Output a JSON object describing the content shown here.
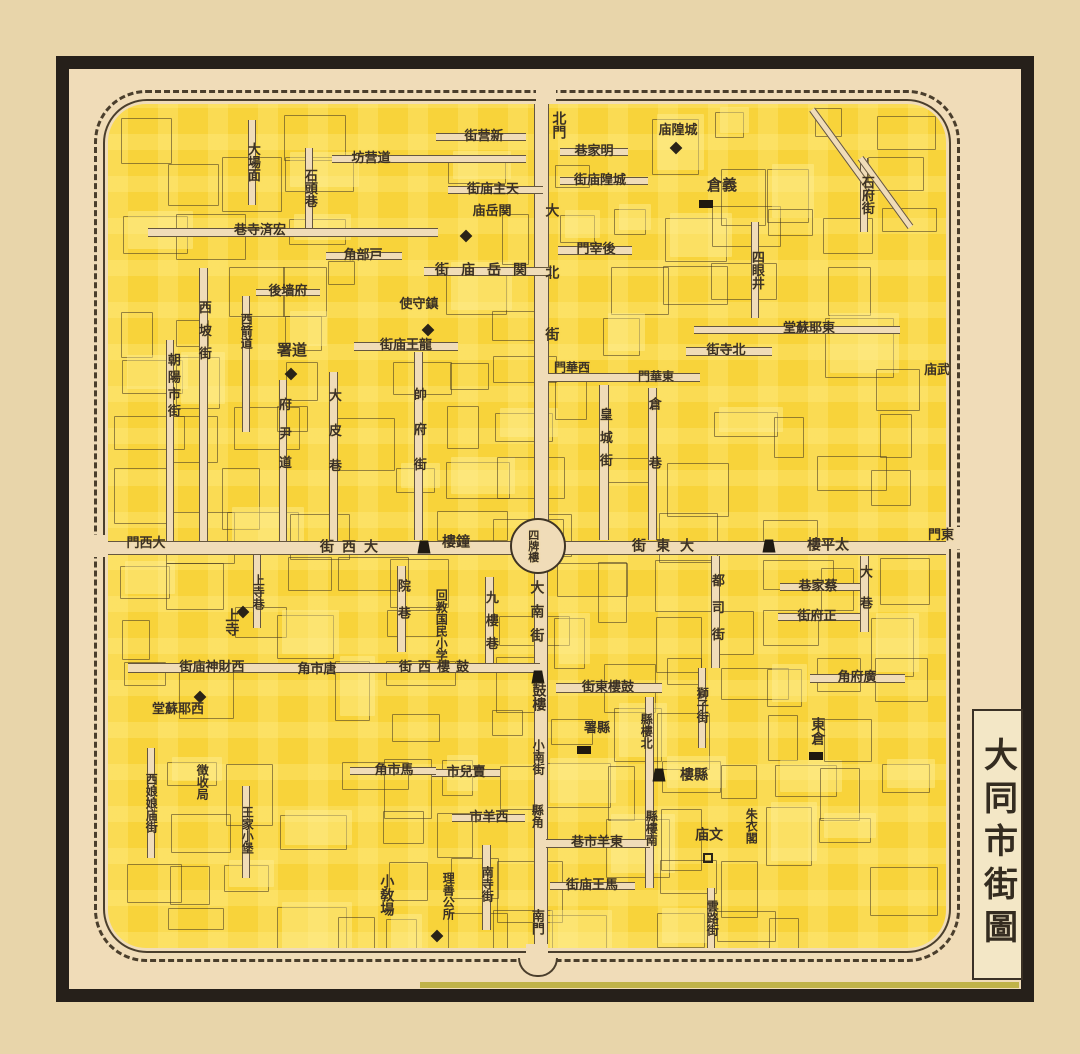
{
  "title": {
    "text": "大同市街圖"
  },
  "colors": {
    "paper": "#e8d5aa",
    "map_paper": "#f0dcb8",
    "block_yellow": "#f8d33a",
    "block_yellow_light": "#ffee8c",
    "ink": "#3b3126",
    "frame_black": "#26201a",
    "wall_line": "#4a3e2c",
    "olive_strip": "#b7ab35"
  },
  "map": {
    "center_landmark": "四牌樓",
    "labels": [
      {
        "t": "北門",
        "x": 558,
        "y": 125,
        "o": "v",
        "s": 14
      },
      {
        "t": "新营街",
        "x": 484,
        "y": 137,
        "o": "r",
        "s": 13
      },
      {
        "t": "道营坊",
        "x": 371,
        "y": 159,
        "o": "r",
        "s": 13
      },
      {
        "t": "明家巷",
        "x": 594,
        "y": 152,
        "o": "r",
        "s": 13
      },
      {
        "t": "城隍庙街",
        "x": 600,
        "y": 181,
        "o": "r",
        "s": 13
      },
      {
        "t": "城隍庙",
        "x": 678,
        "y": 131,
        "o": "r",
        "s": 13
      },
      {
        "t": "義倉",
        "x": 722,
        "y": 186,
        "o": "r",
        "s": 15
      },
      {
        "t": "石府街",
        "x": 866,
        "y": 195,
        "o": "v",
        "s": 13
      },
      {
        "t": "四眼井",
        "x": 756,
        "y": 270,
        "o": "v",
        "s": 13
      },
      {
        "t": "大場面",
        "x": 252,
        "y": 162,
        "o": "v",
        "s": 13
      },
      {
        "t": "石頭巷",
        "x": 309,
        "y": 188,
        "o": "v",
        "s": 13
      },
      {
        "t": "宏済寺巷",
        "x": 260,
        "y": 231,
        "o": "r",
        "s": 13
      },
      {
        "t": "天主庙街",
        "x": 493,
        "y": 190,
        "o": "r",
        "s": 13
      },
      {
        "t": "関岳庙",
        "x": 492,
        "y": 212,
        "o": "r",
        "s": 13
      },
      {
        "t": "関岳庙街",
        "x": 487,
        "y": 271,
        "o": "r",
        "s": 14,
        "ls": 12
      },
      {
        "t": "戸部角",
        "x": 363,
        "y": 256,
        "o": "r",
        "s": 13
      },
      {
        "t": "後宰門",
        "x": 596,
        "y": 250,
        "o": "r",
        "s": 13
      },
      {
        "t": "大北街",
        "x": 551,
        "y": 296,
        "o": "v",
        "s": 14,
        "ls": 48
      },
      {
        "t": "府墙後",
        "x": 288,
        "y": 292,
        "o": "r",
        "s": 13
      },
      {
        "t": "西坡街",
        "x": 203,
        "y": 335,
        "o": "v",
        "s": 13,
        "ls": 10
      },
      {
        "t": "朝陽市街",
        "x": 172,
        "y": 387,
        "o": "v",
        "s": 13,
        "ls": 4
      },
      {
        "t": "西箭道",
        "x": 246,
        "y": 331,
        "o": "v",
        "s": 12
      },
      {
        "t": "鎮守使",
        "x": 419,
        "y": 305,
        "o": "r",
        "s": 13
      },
      {
        "t": "道署",
        "x": 292,
        "y": 351,
        "o": "r",
        "s": 15
      },
      {
        "t": "龍王庙街",
        "x": 406,
        "y": 346,
        "o": "r",
        "s": 13
      },
      {
        "t": "帥府街",
        "x": 418,
        "y": 440,
        "o": "v",
        "s": 13,
        "ls": 22
      },
      {
        "t": "府尹道",
        "x": 283,
        "y": 441,
        "o": "v",
        "s": 13,
        "ls": 16
      },
      {
        "t": "大皮巷",
        "x": 333,
        "y": 441,
        "o": "v",
        "s": 13,
        "ls": 22
      },
      {
        "t": "西華門",
        "x": 572,
        "y": 368,
        "o": "r",
        "s": 12
      },
      {
        "t": "東華門",
        "x": 656,
        "y": 377,
        "o": "r",
        "s": 12
      },
      {
        "t": "皇城街",
        "x": 604,
        "y": 442,
        "o": "v",
        "s": 13,
        "ls": 10
      },
      {
        "t": "倉巷",
        "x": 653,
        "y": 456,
        "o": "v",
        "s": 13,
        "ls": 46
      },
      {
        "t": "北寺街",
        "x": 726,
        "y": 351,
        "o": "r",
        "s": 13
      },
      {
        "t": "東耶蘇堂",
        "x": 809,
        "y": 329,
        "o": "r",
        "s": 13
      },
      {
        "t": "武庙",
        "x": 937,
        "y": 371,
        "o": "r",
        "s": 13
      },
      {
        "t": "東門",
        "x": 941,
        "y": 536,
        "o": "r",
        "s": 13
      },
      {
        "t": "大西門",
        "x": 146,
        "y": 544,
        "o": "r",
        "s": 13
      },
      {
        "t": "大西街",
        "x": 353,
        "y": 548,
        "o": "r",
        "s": 14,
        "ls": 8
      },
      {
        "t": "鐘樓",
        "x": 456,
        "y": 543,
        "o": "r",
        "s": 14
      },
      {
        "t": "四牌樓",
        "x": 533,
        "y": 546,
        "o": "v",
        "s": 11
      },
      {
        "t": "大東街",
        "x": 668,
        "y": 547,
        "o": "r",
        "s": 14,
        "ls": 10
      },
      {
        "t": "太平樓",
        "x": 828,
        "y": 546,
        "o": "r",
        "s": 14
      },
      {
        "t": "蔡家巷",
        "x": 818,
        "y": 587,
        "o": "r",
        "s": 13
      },
      {
        "t": "正府街",
        "x": 817,
        "y": 617,
        "o": "r",
        "s": 13
      },
      {
        "t": "大巷",
        "x": 864,
        "y": 596,
        "o": "v",
        "s": 13,
        "ls": 18
      },
      {
        "t": "上寺巷",
        "x": 258,
        "y": 592,
        "o": "v",
        "s": 12
      },
      {
        "t": "上寺",
        "x": 231,
        "y": 622,
        "o": "v",
        "s": 14
      },
      {
        "t": "院巷",
        "x": 402,
        "y": 606,
        "o": "v",
        "s": 13,
        "ls": 14
      },
      {
        "t": "回教国民小学",
        "x": 441,
        "y": 625,
        "o": "v",
        "s": 12
      },
      {
        "t": "九樓巷",
        "x": 490,
        "y": 625,
        "o": "v",
        "s": 13,
        "ls": 10
      },
      {
        "t": "大南街",
        "x": 536,
        "y": 616,
        "o": "v",
        "s": 14,
        "ls": 10
      },
      {
        "t": "都司街",
        "x": 716,
        "y": 614,
        "o": "v",
        "s": 13,
        "ls": 14
      },
      {
        "t": "廣府角",
        "x": 857,
        "y": 678,
        "o": "r",
        "s": 13
      },
      {
        "t": "西財神庙街",
        "x": 212,
        "y": 668,
        "o": "r",
        "s": 13
      },
      {
        "t": "唐市角",
        "x": 317,
        "y": 670,
        "o": "r",
        "s": 13
      },
      {
        "t": "鼓樓西街",
        "x": 437,
        "y": 668,
        "o": "r",
        "s": 13,
        "ls": 6
      },
      {
        "t": "鼓樓",
        "x": 538,
        "y": 697,
        "o": "v",
        "s": 14
      },
      {
        "t": "鼓樓東街",
        "x": 608,
        "y": 688,
        "o": "r",
        "s": 13
      },
      {
        "t": "縣署",
        "x": 597,
        "y": 729,
        "o": "r",
        "s": 13
      },
      {
        "t": "縣樓北",
        "x": 646,
        "y": 731,
        "o": "v",
        "s": 12
      },
      {
        "t": "獅子街",
        "x": 702,
        "y": 705,
        "o": "v",
        "s": 12
      },
      {
        "t": "西耶蘇堂",
        "x": 178,
        "y": 710,
        "o": "r",
        "s": 13
      },
      {
        "t": "徴收局",
        "x": 202,
        "y": 782,
        "o": "v",
        "s": 12
      },
      {
        "t": "西娘娘庙街",
        "x": 151,
        "y": 803,
        "o": "v",
        "s": 12
      },
      {
        "t": "王家小堡",
        "x": 247,
        "y": 830,
        "o": "v",
        "s": 12
      },
      {
        "t": "馬市角",
        "x": 394,
        "y": 771,
        "o": "r",
        "s": 13
      },
      {
        "t": "賣兒市",
        "x": 466,
        "y": 773,
        "o": "r",
        "s": 13
      },
      {
        "t": "西羊市",
        "x": 489,
        "y": 818,
        "o": "r",
        "s": 13
      },
      {
        "t": "小南街",
        "x": 538,
        "y": 757,
        "o": "v",
        "s": 12
      },
      {
        "t": "縣角",
        "x": 537,
        "y": 816,
        "o": "v",
        "s": 12
      },
      {
        "t": "縣樓",
        "x": 694,
        "y": 776,
        "o": "r",
        "s": 14
      },
      {
        "t": "縣樓南",
        "x": 651,
        "y": 828,
        "o": "v",
        "s": 12
      },
      {
        "t": "東羊市巷",
        "x": 597,
        "y": 843,
        "o": "r",
        "s": 13
      },
      {
        "t": "馬王庙街",
        "x": 592,
        "y": 886,
        "o": "r",
        "s": 13
      },
      {
        "t": "文庙",
        "x": 709,
        "y": 836,
        "o": "r",
        "s": 14
      },
      {
        "t": "朱衣閣",
        "x": 751,
        "y": 826,
        "o": "v",
        "s": 12
      },
      {
        "t": "東倉",
        "x": 817,
        "y": 731,
        "o": "v",
        "s": 14
      },
      {
        "t": "雲路街",
        "x": 712,
        "y": 918,
        "o": "v",
        "s": 12
      },
      {
        "t": "小敎場",
        "x": 386,
        "y": 895,
        "o": "v",
        "s": 14
      },
      {
        "t": "理善公所",
        "x": 448,
        "y": 896,
        "o": "v",
        "s": 12
      },
      {
        "t": "南寺街",
        "x": 487,
        "y": 884,
        "o": "v",
        "s": 12
      },
      {
        "t": "南門",
        "x": 536,
        "y": 922,
        "o": "v",
        "s": 13
      }
    ],
    "icons": [
      {
        "type": "tower",
        "name": "bell-tower-icon",
        "x": 424,
        "y": 547
      },
      {
        "type": "tower",
        "name": "taiping-tower-icon",
        "x": 769,
        "y": 546
      },
      {
        "type": "tower",
        "name": "drum-tower-icon",
        "x": 538,
        "y": 677
      },
      {
        "type": "tower",
        "name": "county-tower-icon",
        "x": 659,
        "y": 775
      },
      {
        "type": "diamond",
        "name": "guanyue-temple-marker-icon",
        "x": 466,
        "y": 236
      },
      {
        "type": "diamond",
        "name": "garrison-hq-marker-icon",
        "x": 428,
        "y": 330
      },
      {
        "type": "diamond",
        "name": "circuit-office-marker-icon",
        "x": 291,
        "y": 374
      },
      {
        "type": "diamond",
        "name": "upper-temple-marker-icon",
        "x": 243,
        "y": 612
      },
      {
        "type": "diamond",
        "name": "west-church-marker-icon",
        "x": 200,
        "y": 697
      },
      {
        "type": "diamond",
        "name": "lishan-office-marker-icon",
        "x": 437,
        "y": 936
      },
      {
        "type": "diamond",
        "name": "chenghuang-temple-marker-icon",
        "x": 676,
        "y": 148
      },
      {
        "type": "store",
        "name": "yicang-granary-icon",
        "x": 706,
        "y": 204
      },
      {
        "type": "store",
        "name": "east-granary-icon",
        "x": 816,
        "y": 756
      },
      {
        "type": "store",
        "name": "county-office-icon",
        "x": 584,
        "y": 750
      },
      {
        "type": "square",
        "name": "wenmiao-marker-icon",
        "x": 708,
        "y": 858
      }
    ]
  }
}
